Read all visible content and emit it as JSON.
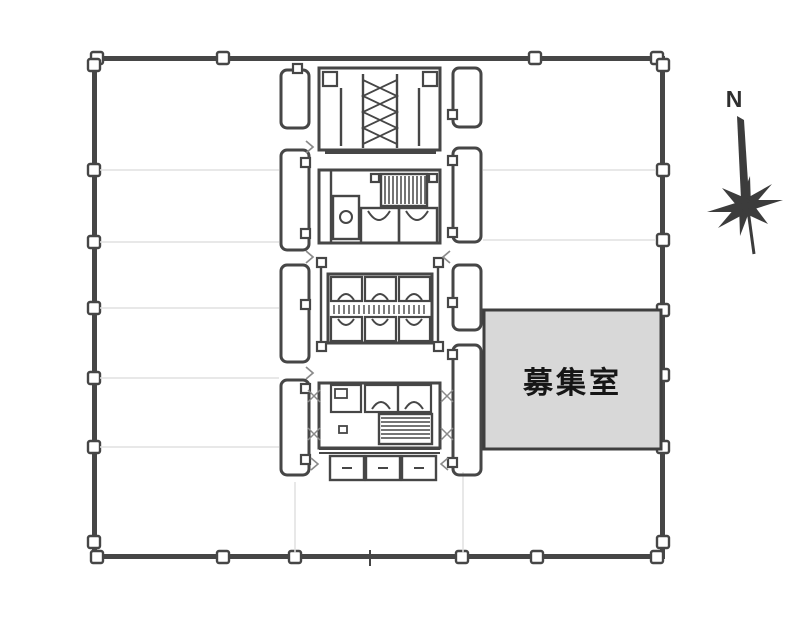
{
  "plan": {
    "vacant_room": {
      "label": "募集室",
      "fill_color": "#d8d8d8"
    },
    "compass": {
      "north_label": "N"
    },
    "colors": {
      "wall": "#464646",
      "faint_grid": "#e0e0e0",
      "background": "#ffffff",
      "label_ink": "#161616"
    },
    "icons": {
      "compass": "compass-rose-icon (8-point star with north needle)",
      "staircase": "staircase-icon (herringbone zigzag)",
      "escalator": "escalator-icon (striped band)",
      "elevator": "elevator-car-icon (cell with door arc)"
    }
  }
}
